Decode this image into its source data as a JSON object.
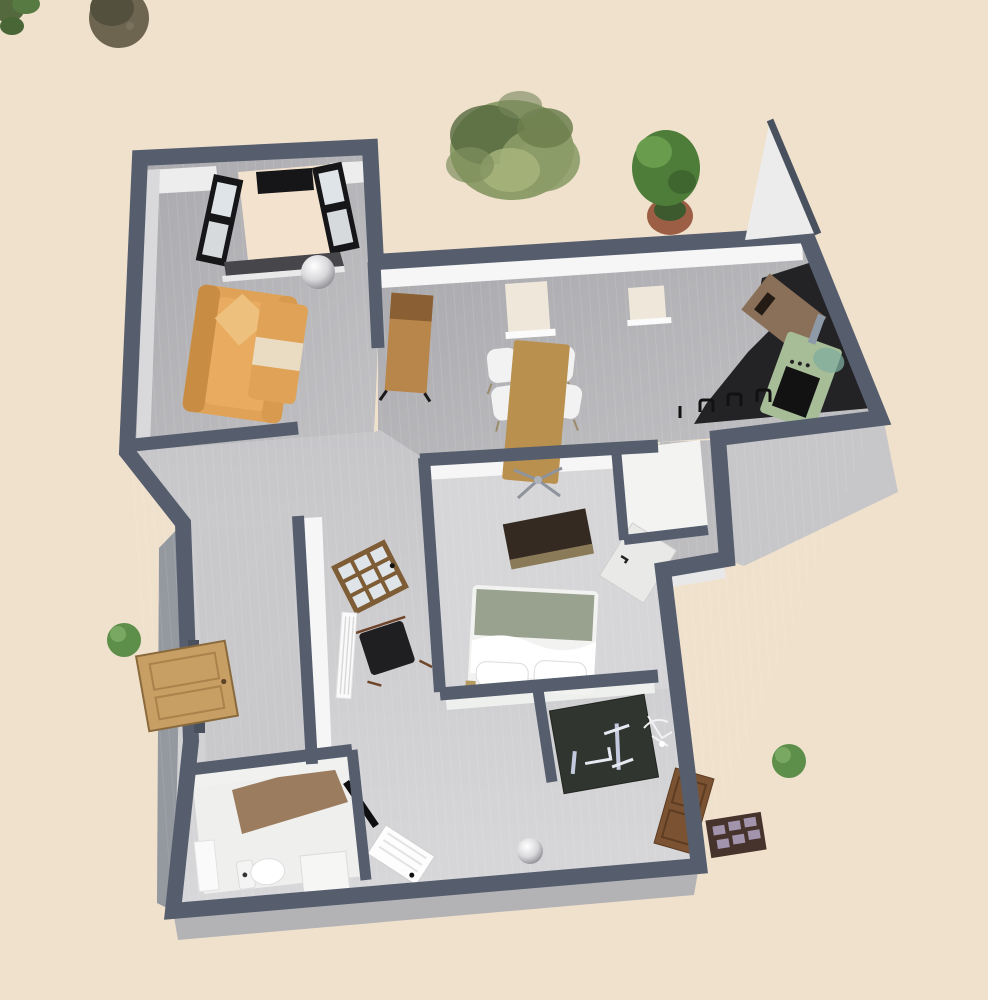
{
  "app": {
    "type": "3d-floor-plan-aerial-render",
    "view": "bird's-eye perspective of a furnished apartment"
  },
  "colors": {
    "background": "#f0e1cd",
    "wall": "#565e6e",
    "wall_dark": "#49505e",
    "wall_face_white": "#f6f6f6",
    "wall_face_gray": "#d9d9db",
    "wall_face_side": "#94989f",
    "foundation": "#b3b3b6",
    "foundation_light": "#c7c7c9",
    "floor_main": "#b2b2b6",
    "floor_dining": "#bdbdc0",
    "floor_lower": "#cdcdd0",
    "floor_bedroom": "#d6d6d8",
    "floor_entry": "#c9c9cc",
    "sofa": "#dfa257",
    "sofa_light": "#eec07e",
    "sofa_dark": "#c88c42",
    "cabinet_wood": "#b8854a",
    "cabinet_wood_dark": "#8a5f33",
    "table_wood": "#b9904e",
    "chair_white": "#f2f2f2",
    "counter_black": "#232326",
    "stove_green": "#a6bd98",
    "panel_brown": "#8a7058",
    "dresser_dark": "#352a22",
    "dresser_base": "#8a7a58",
    "bed_blanket": "#99a18f",
    "bed_white": "#f2f2f1",
    "door_wood": "#c79e63",
    "glass_door_frame": "#7d5c36",
    "glass_pane": "#dfe4e8",
    "door_white": "#e9e9e8",
    "chair_black": "#1f1f22",
    "gym_dark": "#30352f",
    "gym_metal": "#c3cade",
    "door_brown": "#7b5232",
    "mat_brown": "#46332b",
    "mat_square": "#b4a6c4",
    "bath_floor": "#9b7c5e",
    "fixture_white": "#fafafa",
    "black_frame": "#161618",
    "balcony_beige": "#f3e3ce",
    "foliage": "#7d9058",
    "foliage_dark": "#55693f",
    "foliage_light": "#a9b77d",
    "trunk": "#6e6550",
    "trunk_dark": "#53503e",
    "pot_terracotta": "#9c5f45",
    "metal_sphere": "#c9c9cd"
  },
  "scene": {
    "rooms": [
      {
        "name": "living-room",
        "position": "top-left",
        "floor": "gray planks"
      },
      {
        "name": "dining-area",
        "position": "center-top",
        "floor": "gray planks"
      },
      {
        "name": "kitchen",
        "position": "right-wing",
        "floor": "gray with black counter zone"
      },
      {
        "name": "bedroom",
        "position": "center",
        "floor": "light gray planks"
      },
      {
        "name": "closet",
        "position": "right-of-bedroom"
      },
      {
        "name": "hallway",
        "position": "center-left corridor"
      },
      {
        "name": "entry-hall",
        "position": "lower-left"
      },
      {
        "name": "bathroom",
        "position": "bottom-left"
      },
      {
        "name": "gym-room",
        "position": "bottom-center-right"
      }
    ],
    "furniture": [
      "orange sofa with cushion",
      "orange coffee table",
      "chrome dome lamp",
      "balcony alcove with black french windows",
      "tall wooden cabinet",
      "two wall radiators",
      "wooden dining table with pedestal",
      "four white chairs",
      "black kitchen counter",
      "sage-green stove",
      "brown wall panel",
      "wall hooks",
      "dark dresser",
      "double bed with white duvet and two pillows",
      "white open bedroom door",
      "glass-paned interior door",
      "black armchair",
      "white radiator",
      "wooden front door swung open",
      "toilet",
      "sink vanity",
      "shower base",
      "white bathroom door",
      "dark gym bench with barbell",
      "white exercise machine",
      "brown rear door swung open",
      "checkered doormat",
      "chrome dome lamp in hallway"
    ],
    "vegetation": [
      "tree trunk top-left",
      "leaf cluster top-left corner",
      "large feathery bush",
      "potted plant in terracotta pot",
      "small round bush left",
      "small round bush right"
    ]
  }
}
